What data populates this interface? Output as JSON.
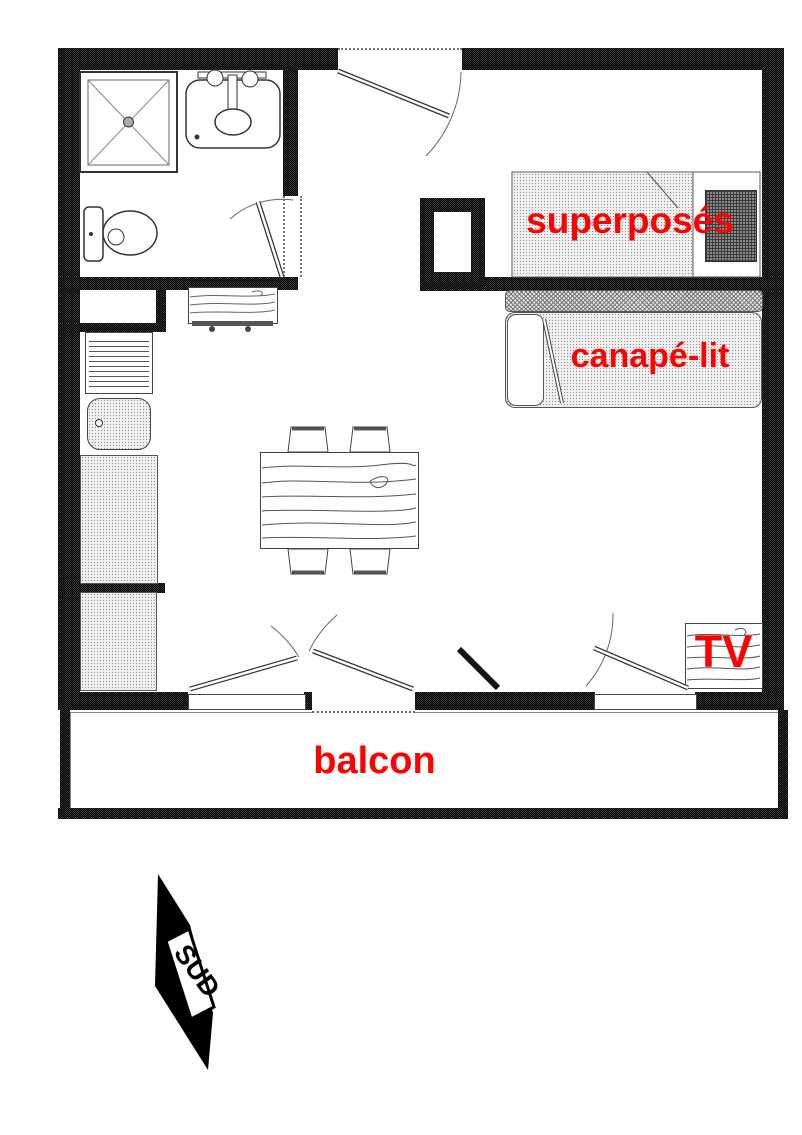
{
  "floorplan": {
    "labels": {
      "bunk_beds": "superposés",
      "sofa_bed": "canapé-lit",
      "tv": "TV",
      "balcony": "balcon",
      "compass_south": "SUD"
    },
    "colors": {
      "label_red": "#ff0000",
      "wall_black": "#111111"
    }
  }
}
